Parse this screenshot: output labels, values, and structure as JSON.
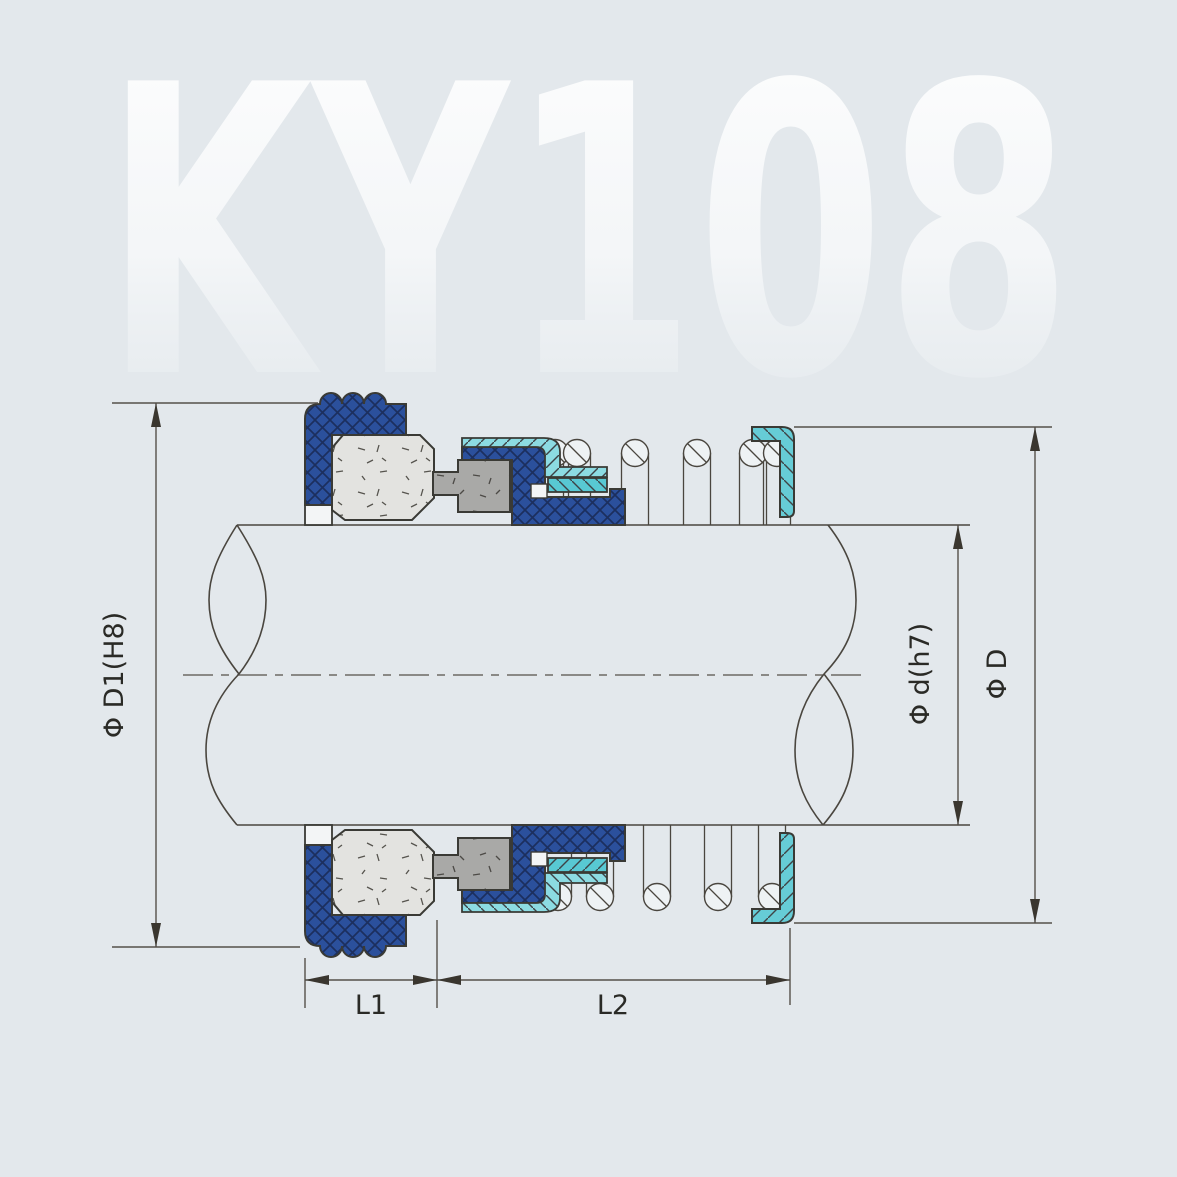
{
  "watermark": {
    "text": "KY108"
  },
  "diagram": {
    "title": "Mechanical seal cross-section",
    "labels": {
      "d1": "Φ D1(H8)",
      "d": "Φ d(h7)",
      "D": "Φ D",
      "l1": "L1",
      "l2": "L2"
    },
    "colors": {
      "background": "#e3e8ec",
      "part_blue": "#2b509c",
      "blue_hatch": "#1c2f5e",
      "gasket_cyan_light": "#8cdbe2",
      "gasket_cyan_mid": "#58c8d3",
      "cup_cyan": "#66ccd6",
      "seat_gray": "#a9a9a7",
      "face_gray": "#e3e3e0",
      "white_part": "#f3f5f6",
      "line_dark": "#3a3a35",
      "line_thin": "#55504a",
      "text": "#2a2a26"
    }
  }
}
